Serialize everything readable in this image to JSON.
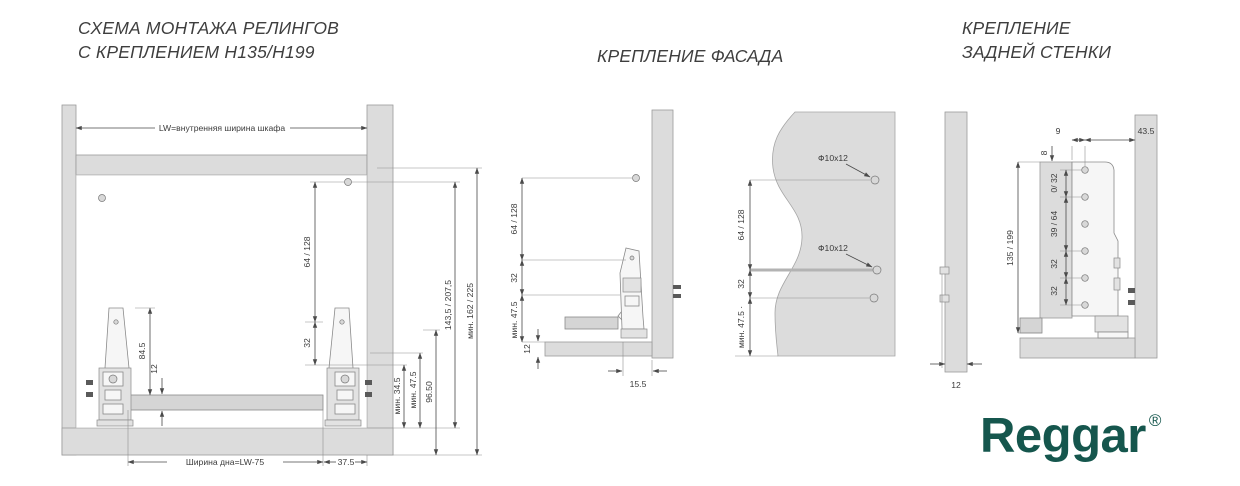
{
  "titles": {
    "rail_scheme_line1": "СХЕМА МОНТАЖА РЕЛИНГОВ",
    "rail_scheme_line2": "С КРЕПЛЕНИЕМ Н135/Н199",
    "facade": "КРЕПЛЕНИЕ ФАСАДА",
    "back_wall_line1": "КРЕПЛЕНИЕ",
    "back_wall_line2": "ЗАДНЕЙ СТЕНКИ"
  },
  "brand": {
    "name": "Reggar",
    "mark": "®",
    "color": "#15564d"
  },
  "rail_scheme": {
    "inner_width": "LW=внутренняя ширина шкафа",
    "rail_offset": "64 / 128",
    "rail_to_hole": "32",
    "side_height": "84.5",
    "bottom_thickness": "12",
    "box_height": "143,5 / 207,5",
    "min_inner_height": "мин. 162 / 225",
    "min_34_5": "мин. 34.5",
    "min_47_5": "мин. 47.5",
    "dim_96_5": "96.50",
    "bottom_width": "Ширина дна=LW-75",
    "side_clearance": "37.5"
  },
  "facade_section": {
    "rail_offset": "64 / 128",
    "hole_step": "32",
    "min_47_5": "мин. 47.5",
    "bottom_gap": "12",
    "bracket_depth": "15.5"
  },
  "facade_front": {
    "hole_top": "Ф10x12",
    "hole_mid": "Ф10x12",
    "rail_offset": "64 / 128",
    "hole_step": "32",
    "min_47_5": "мин. 47.5 ·"
  },
  "facade_side": {
    "thickness": "12"
  },
  "back_wall": {
    "offset_front": "9",
    "offset_wall": "43.5",
    "top_offset": "8",
    "hole_0_32": "0/ 32",
    "hole_39_64": "39 / 64",
    "hole_32_a": "32",
    "hole_32_b": "32",
    "panel_height": "135 / 199"
  }
}
